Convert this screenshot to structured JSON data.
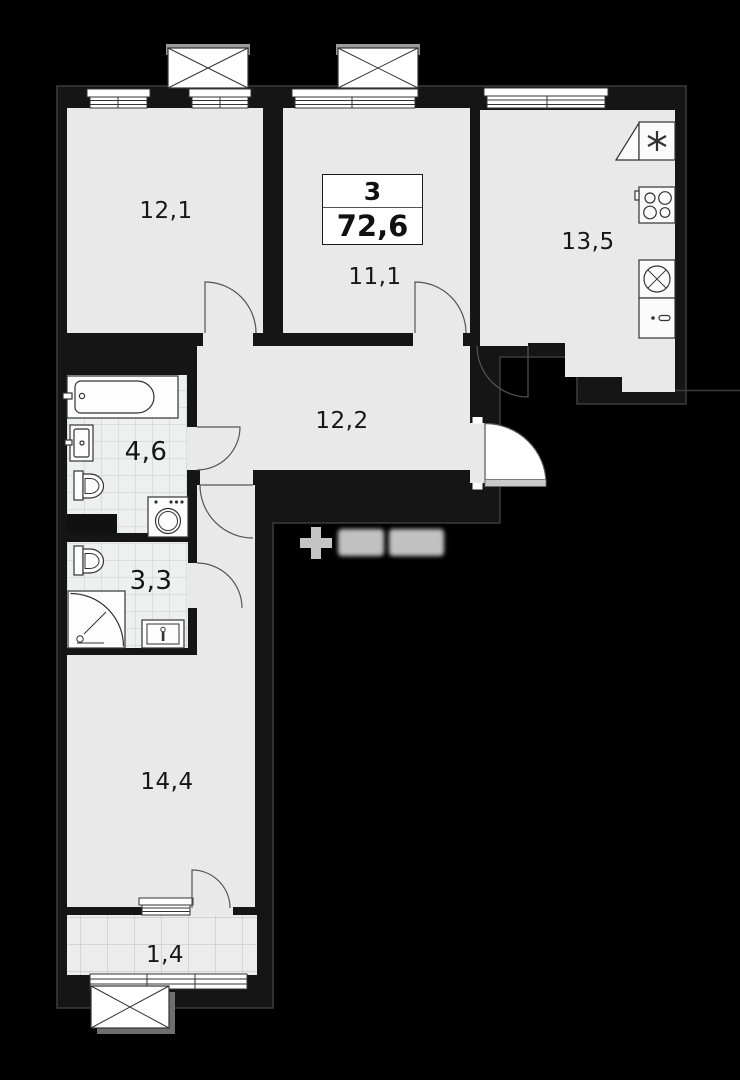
{
  "floorplan": {
    "unit_type_label": "3",
    "total_area": "72,6",
    "rooms": [
      {
        "name": "bedroom-top-left",
        "area": "12,1"
      },
      {
        "name": "bedroom-middle",
        "area": "11,1"
      },
      {
        "name": "kitchen",
        "area": "13,5"
      },
      {
        "name": "hallway",
        "area": "12,2"
      },
      {
        "name": "bathroom",
        "area": "4,6"
      },
      {
        "name": "wc",
        "area": "3,3"
      },
      {
        "name": "living-room",
        "area": "14,4"
      },
      {
        "name": "balcony",
        "area": "1,4"
      }
    ],
    "watermark_symbol": "+",
    "colors": {
      "background": "#000000",
      "floor": "#e9e9e9",
      "tile_floor": "#eeefef",
      "wall_outline": "#3c3c3c",
      "fixture_line": "#333333",
      "label_text": "#161616",
      "watermark": "#d6d6d6"
    }
  }
}
